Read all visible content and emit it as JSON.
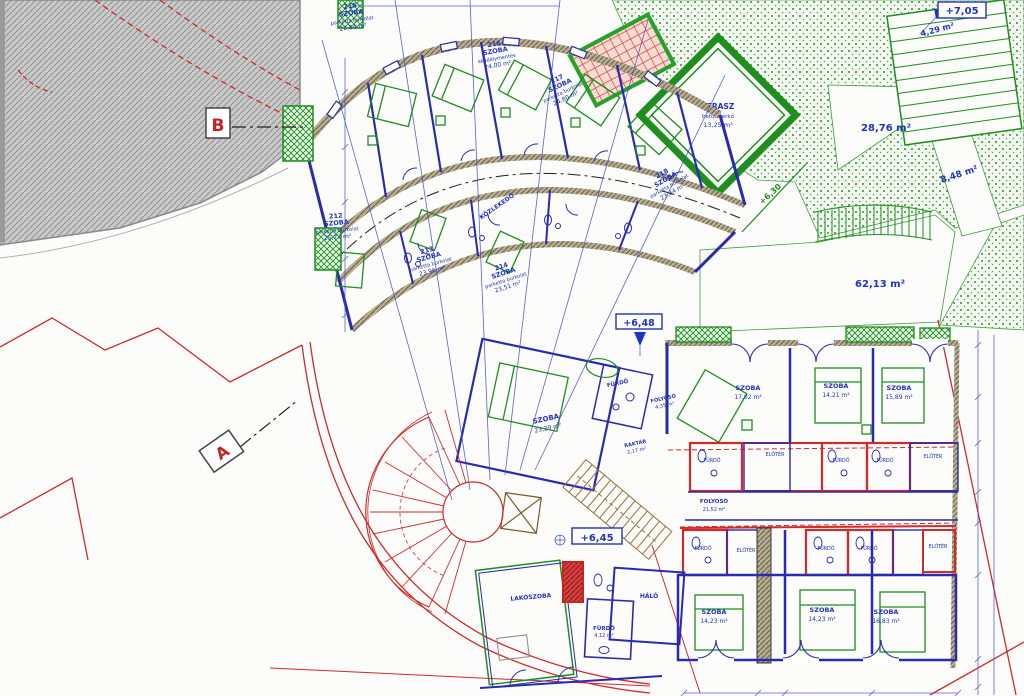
{
  "section_markers": {
    "a": "A",
    "b": "B"
  },
  "levels": {
    "plus705": "+7,05",
    "plus648": "+6,48",
    "plus645": "+6,45",
    "plus630": "+6,30"
  },
  "outdoor": {
    "green_area_1": "28,76 m²",
    "green_area_2": "8,48 m²",
    "green_area_3": "62,13 m²",
    "stair_area": "4,29 m²",
    "terrace": {
      "name": "TERASZ",
      "material": "beton térkő",
      "area": "13,25 m²"
    }
  },
  "wing": {
    "corridor": "KÖZLEKEDŐ",
    "rooms": [
      {
        "num": "212",
        "name": "SZOBA",
        "note": "parketta burkolat",
        "area": "25,77 m²"
      },
      {
        "num": "213",
        "name": "SZOBA",
        "note": "parketta burkolat",
        "area": "23,96 m²"
      },
      {
        "num": "214",
        "name": "SZOBA",
        "note": "parketta burkolat",
        "area": "23,51 m²"
      },
      {
        "num": "215",
        "name": "SZOBA",
        "note": "parketta burkolat",
        "area": "22,84 m²"
      },
      {
        "num": "216",
        "name": "SZOBA",
        "note": "akadálymentes",
        "area": "24,00 m²"
      },
      {
        "num": "217",
        "name": "SZOBA",
        "note": "parketta burkolat",
        "area": "24,80 m²"
      },
      {
        "num": "218",
        "name": "SZOBA",
        "note": "parketta burkolat",
        "area": "23,84 m²"
      }
    ]
  },
  "center_unit": {
    "room": {
      "name": "SZOBA",
      "area": "23,29 m²"
    },
    "bath": "FÜRDŐ",
    "hall": {
      "name": "FOLYOSÓ",
      "area": "4,35 m²"
    },
    "storage": {
      "name": "RAKTÁR",
      "area": "2,17 m²"
    }
  },
  "east_block": {
    "rooms": [
      {
        "name": "SZOBA",
        "area": "17,02 m²"
      },
      {
        "name": "SZOBA",
        "area": "14,21 m²"
      },
      {
        "name": "SZOBA",
        "area": "15,89 m²"
      }
    ],
    "corridor": {
      "name": "FOLYOSÓ",
      "area": "21,52 m²"
    },
    "baths": [
      "FÜRDŐ",
      "ELŐTÉR",
      "FÜRDŐ",
      "FÜRDŐ",
      "ELŐTÉR"
    ]
  },
  "south_block": {
    "rooms": [
      {
        "name": "SZOBA",
        "area": "14,23 m²"
      },
      {
        "name": "SZOBA",
        "area": "14,23 m²"
      },
      {
        "name": "SZOBA",
        "area": "16,83 m²"
      }
    ],
    "baths": [
      "FÜRDŐ",
      "ELŐTÉR",
      "FÜRDŐ",
      "FÜRDŐ",
      "ELŐTÉR"
    ]
  },
  "apartment": {
    "living": "LAKÓSZOBA",
    "bedroom": "HÁLÓ",
    "bath": "FÜRDŐ",
    "bath_area": "4,12 m²"
  },
  "colors": {
    "wall_blue": "#2a2ab0",
    "text_blue": "#2233bb",
    "vegetation_green": "#1e8e1e",
    "boundary_red": "#cf2b2b",
    "terrain_gray": "#c7c7c7"
  }
}
